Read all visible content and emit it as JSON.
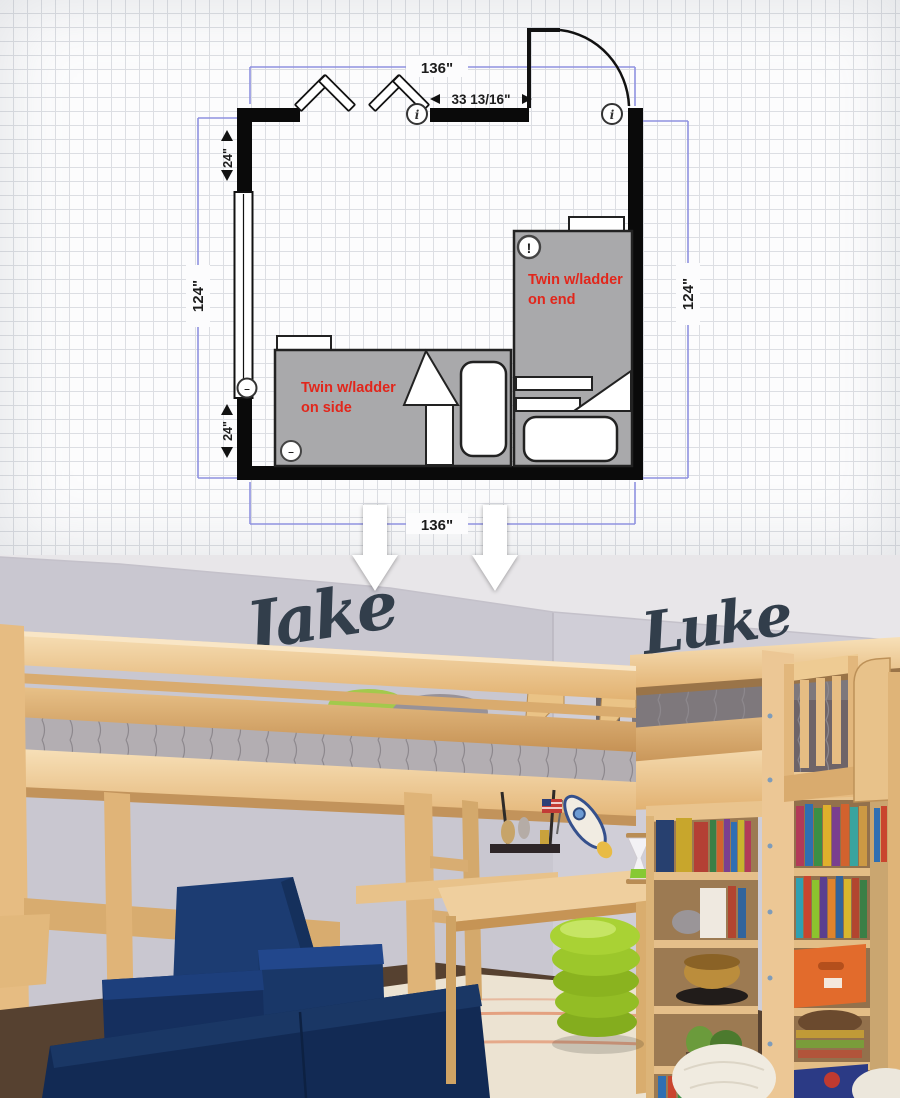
{
  "floor_plan": {
    "dimensions": {
      "top_width": "136\"",
      "bottom_width": "136\"",
      "left_height": "124\"",
      "right_height": "124\"",
      "left_wall_upper_segment": "24\"",
      "left_wall_lower_segment": "24\"",
      "entry_wall_segment": "33 13/16\""
    },
    "beds": {
      "end_bed": {
        "label": "Twin w/ladder on end",
        "line1": "Twin w/ladder",
        "line2": "on end"
      },
      "side_bed": {
        "label": "Twin w/ladder on side",
        "line1": "Twin w/ladder",
        "line2": "on side"
      }
    },
    "icons": {
      "info_glyph": "i",
      "warning_glyph": "!",
      "handle_glyph": "–"
    },
    "colors": {
      "wall": "#0a0a0a",
      "bed_fill": "#a9a9ab",
      "bed_label_red": "#e2261b",
      "dimension_line": "#8f92e0",
      "grid_line": "#dcdee3"
    }
  },
  "photo": {
    "signs": {
      "left_name": "Jake",
      "right_name": "Luke"
    },
    "colors": {
      "sign_navy": "#323e4b",
      "wall_lavender": "#c9c7d0",
      "ceiling": "#e8e6e9",
      "wood_light": "#f0cd9a",
      "couch_navy": "#16356b",
      "stool_green": "#9cc72b",
      "bin_orange": "#e26b2c",
      "rug_cream": "#ece3d2"
    }
  }
}
